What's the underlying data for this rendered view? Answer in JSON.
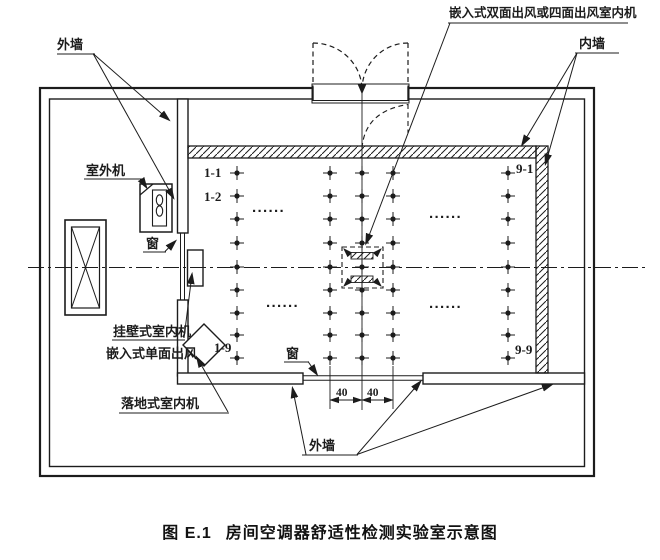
{
  "figure": {
    "caption_no": "图 E.1",
    "caption_title": "房间空调器舒适性检测实验室示意图"
  },
  "labels": {
    "exterior_wall_top": "外墙",
    "cassette_unit": "嵌入式双面出风或四面出风室内机",
    "interior_wall": "内墙",
    "outdoor_unit": "室外机",
    "window_left": "窗",
    "wall_mounted_indoor_unit": "挂壁式室内机",
    "embedded_single_outlet": "嵌入式单面出风",
    "floor_standing_indoor_unit": "落地式室内机",
    "window_bottom": "窗",
    "exterior_wall_bottom": "外墙"
  },
  "grid": {
    "rows": 9,
    "columns": 9,
    "shown_columns": "1, 4, 5, 6, 9",
    "marker": "crosshair-point",
    "ellipsis": "······",
    "point_labels": {
      "r1c1": "1-1",
      "r2c1": "1-2",
      "r9c1": "1-9",
      "r1c9": "9-1",
      "r9c9": "9-9"
    }
  },
  "dimension": {
    "left": "40",
    "right": "40"
  },
  "colors": {
    "line": "#1c1c1c",
    "background": "#ffffff"
  }
}
